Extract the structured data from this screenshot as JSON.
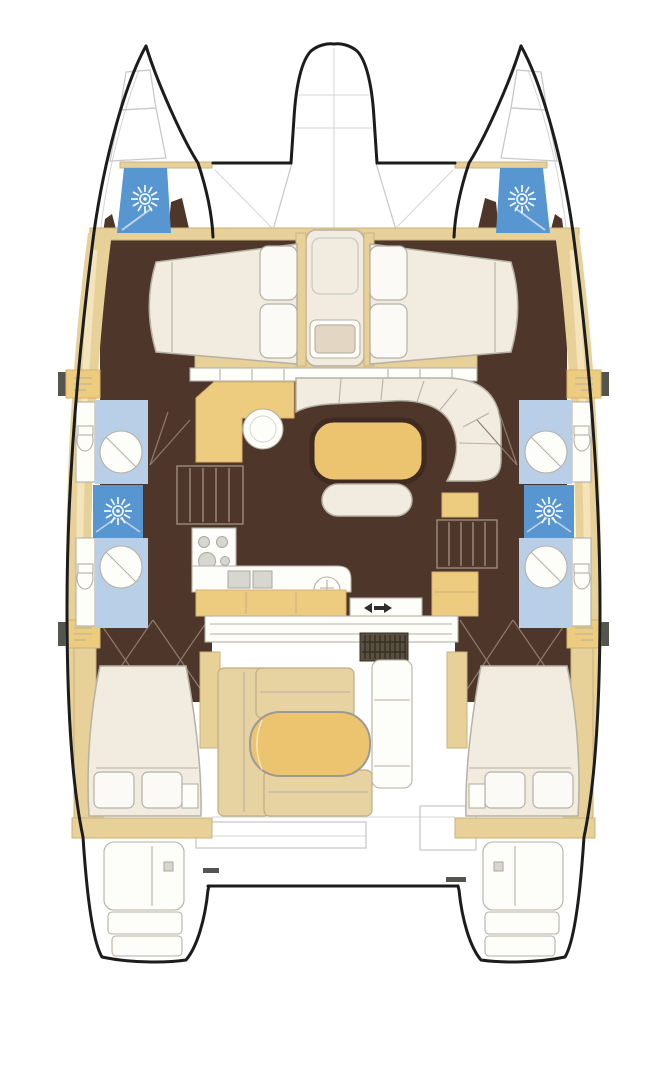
{
  "meta": {
    "description": "Catamaran sailing yacht deck plan, top-down view, four-cabin two-bathroom layout with salon, galley, cockpit and trampoline bow",
    "canvas_width": 667,
    "canvas_height": 1080
  },
  "colors": {
    "background": "#ffffff",
    "hull_outline": "#1c1c1c",
    "faint_line": "#c9c9c9",
    "gray_line": "#a8a8a0",
    "deck_tan": "#e8d099",
    "deck_tan_light": "#f4e7c3",
    "deck_trim": "#c9b27a",
    "floor_brown": "#4e362b",
    "wall_brown": "#3f2b22",
    "furniture_tan": "#edcb7f",
    "furniture_tan_dark": "#d9b169",
    "cockpit_tan": "#e7d2a2",
    "seat_edge": "#bfae85",
    "table_tan": "#ecc36f",
    "cream": "#f1ecdf",
    "cushion_white": "#fbfaf6",
    "fixture_white": "#fdfdfa",
    "soft_edge": "#b5b1a4",
    "bath_blue": "#b9cfe7",
    "hatch_blue": "#5796d0",
    "sun_white": "#ffffff",
    "door_line": "#8f7c6d",
    "stair_line": "#9d8d7c",
    "grate_dark": "#59503f",
    "grate_line": "#352f24",
    "appliance_gray": "#d7d7d0",
    "arrow_dark": "#2e2e2e",
    "dash_dark": "#555550"
  },
  "plan": {
    "type": "catamaran-deck-plan",
    "view": "top-down",
    "areas": {
      "foredeck": [
        "port-bow-anchor-locker",
        "starboard-bow-anchor-locker",
        "trampoline",
        "bow-nacelle",
        "foredeck-sun-hatch-port",
        "foredeck-sun-hatch-starboard",
        "forward-crossbeam"
      ],
      "forward_cabins": [
        "port-forward-double-berth",
        "starboard-forward-double-berth",
        "center-forepeak-berth-with-seat"
      ],
      "midship": [
        "port-bathroom-forward",
        "port-bathroom-aft",
        "port-midship-sun-hatch",
        "starboard-bathroom-forward",
        "starboard-bathroom-aft",
        "starboard-midship-sun-hatch",
        "port-side-deck",
        "starboard-side-deck"
      ],
      "salon": [
        "galley-corner-unit-with-round-sink",
        "galley-stove",
        "galley-aft-counter-with-sink",
        "u-shaped-sofa",
        "dining-table",
        "bench-seat",
        "port-hull-companion-stairs",
        "starboard-hull-companion-stairs",
        "cockpit-sliding-door",
        "door-threshold-marks"
      ],
      "aft": [
        "port-aft-double-berth",
        "starboard-aft-double-berth",
        "cockpit-l-shaped-sofa",
        "cockpit-oval-table",
        "helm-seat-module",
        "engine-hatch-grate",
        "aft-platform",
        "port-transom-steps",
        "starboard-transom-steps"
      ]
    }
  }
}
